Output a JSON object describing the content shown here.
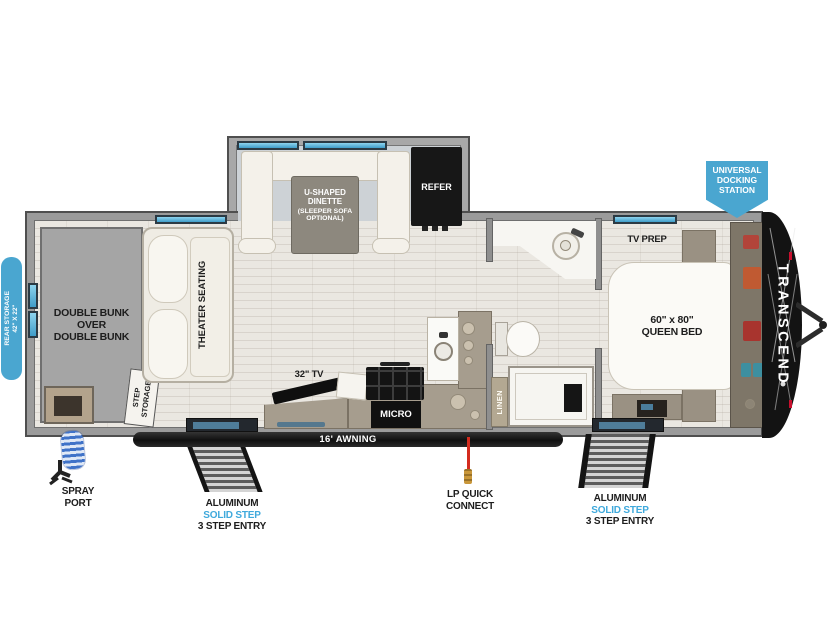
{
  "labels": {
    "rear_storage": [
      "REAR STORAGE",
      "42\" X 22\""
    ],
    "double_bunk": [
      "DOUBLE BUNK",
      "OVER",
      "DOUBLE BUNK"
    ],
    "theater_seating": "THEATER SEATING",
    "step_storage": [
      "STEP",
      "STORAGE"
    ],
    "dinette": [
      "U-SHAPED",
      "DINETTE",
      "(SLEEPER SOFA",
      "OPTIONAL)"
    ],
    "refer": "REFER",
    "tv_32": "32\" TV",
    "micro": "MICRO",
    "linen": "LINEN",
    "tv_prep": "TV PREP",
    "queen_bed": [
      "60\" x 80\"",
      "QUEEN BED"
    ],
    "awning": "16' AWNING",
    "brand": "TRANSCEND",
    "docking_station": [
      "UNIVERSAL",
      "DOCKING",
      "STATION"
    ],
    "spray_port": [
      "SPRAY",
      "PORT"
    ],
    "lp_quick_connect": [
      "LP QUICK",
      "CONNECT"
    ],
    "step_left": [
      "ALUMINUM",
      "SOLID STEP",
      "3 STEP ENTRY"
    ],
    "step_right": [
      "ALUMINUM",
      "SOLID STEP",
      "3 STEP ENTRY"
    ]
  },
  "colors": {
    "callout_blue": "#4AA6D0",
    "window_blue": "#5FC0E4",
    "step_text_blue": "#3FA9DC",
    "lp_red": "#D42B1E",
    "cap_black": "#141414",
    "accent_red": "#C8102E"
  }
}
